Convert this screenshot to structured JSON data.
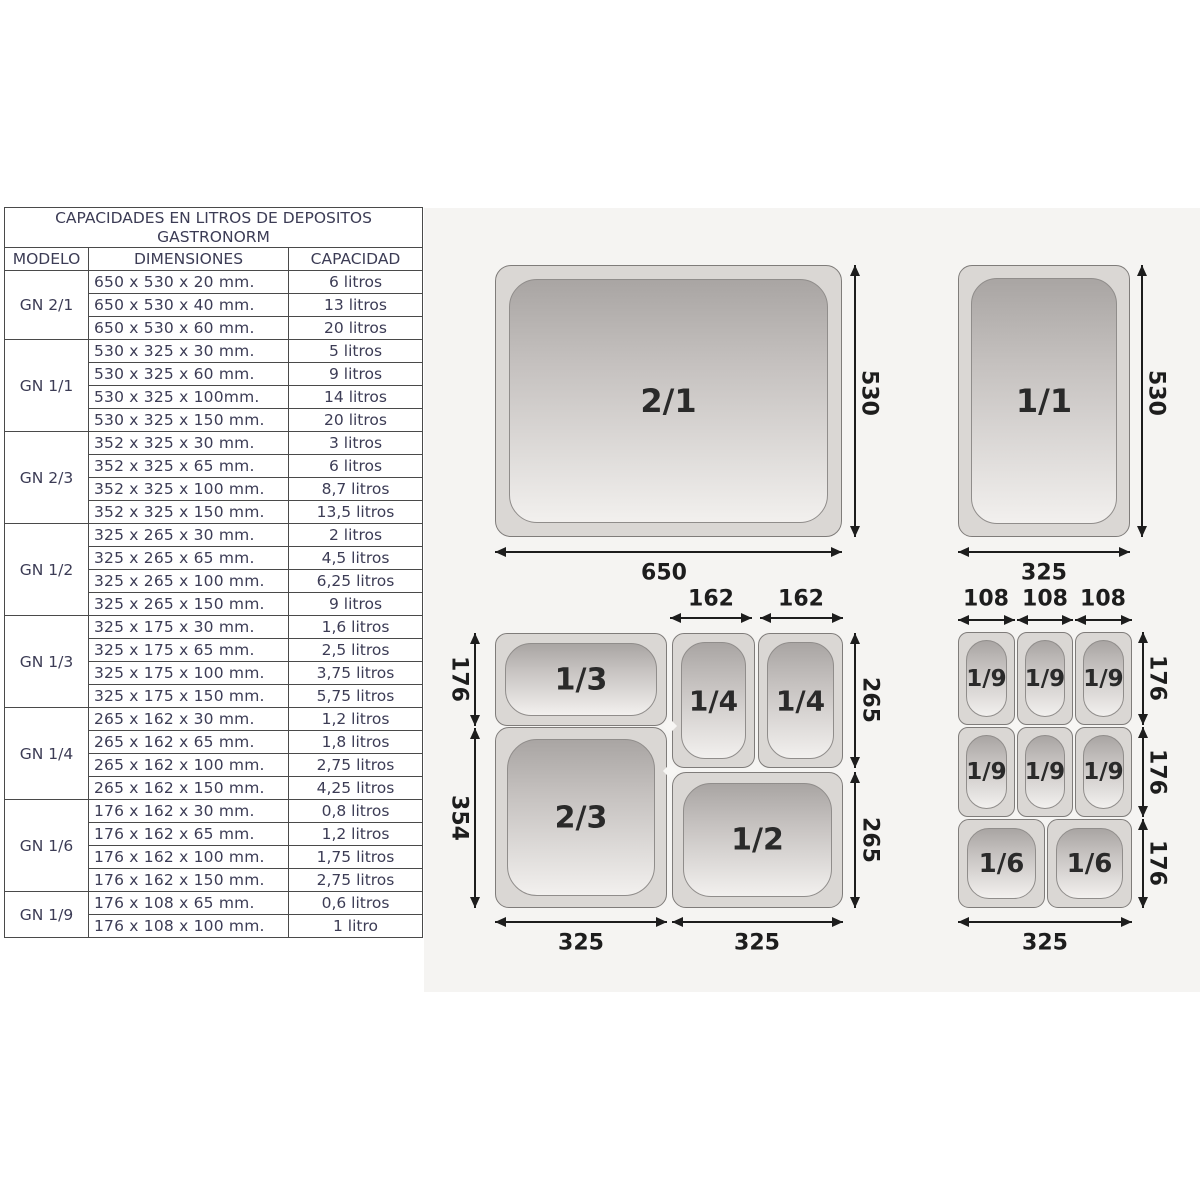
{
  "table": {
    "title_line1": "CAPACIDADES EN LITROS DE DEPOSITOS",
    "title_line2": "GASTRONORM",
    "columns": [
      "MODELO",
      "DIMENSIONES",
      "CAPACIDAD"
    ],
    "groups": [
      {
        "model": "GN 2/1",
        "rows": [
          [
            "650 x 530 x 20 mm.",
            "6 litros"
          ],
          [
            "650 x 530 x 40 mm.",
            "13 litros"
          ],
          [
            "650 x 530 x 60 mm.",
            "20 litros"
          ]
        ]
      },
      {
        "model": "GN 1/1",
        "rows": [
          [
            "530 x 325 x 30 mm.",
            "5 litros"
          ],
          [
            "530 x 325 x 60 mm.",
            "9 litros"
          ],
          [
            "530 x 325 x 100mm.",
            "14 litros"
          ],
          [
            "530 x 325 x 150 mm.",
            "20 litros"
          ]
        ]
      },
      {
        "model": "GN 2/3",
        "rows": [
          [
            "352 x 325 x 30 mm.",
            "3 litros"
          ],
          [
            "352 x 325 x 65 mm.",
            "6 litros"
          ],
          [
            "352 x 325 x 100 mm.",
            "8,7 litros"
          ],
          [
            "352 x 325 x 150 mm.",
            "13,5 litros"
          ]
        ]
      },
      {
        "model": "GN 1/2",
        "rows": [
          [
            "325 x 265 x 30 mm.",
            "2 litros"
          ],
          [
            "325 x 265 x 65 mm.",
            "4,5 litros"
          ],
          [
            "325 x 265 x 100 mm.",
            "6,25 litros"
          ],
          [
            "325 x 265 x 150 mm.",
            "9 litros"
          ]
        ]
      },
      {
        "model": "GN 1/3",
        "rows": [
          [
            "325 x 175 x 30 mm.",
            "1,6 litros"
          ],
          [
            "325 x 175 x 65 mm.",
            "2,5 litros"
          ],
          [
            "325 x 175 x 100 mm.",
            "3,75 litros"
          ],
          [
            "325 x 175 x 150 mm.",
            "5,75 litros"
          ]
        ]
      },
      {
        "model": "GN 1/4",
        "rows": [
          [
            "265 x 162 x 30 mm.",
            "1,2 litros"
          ],
          [
            "265 x 162 x 65 mm.",
            "1,8 litros"
          ],
          [
            "265 x 162 x 100 mm.",
            "2,75 litros"
          ],
          [
            "265 x 162 x 150 mm.",
            "4,25 litros"
          ]
        ]
      },
      {
        "model": "GN 1/6",
        "rows": [
          [
            "176 x 162 x 30 mm.",
            "0,8 litros"
          ],
          [
            "176 x 162 x 65 mm.",
            "1,2 litros"
          ],
          [
            "176 x 162 x 100 mm.",
            "1,75 litros"
          ],
          [
            "176 x 162 x 150 mm.",
            "2,75 litros"
          ]
        ]
      },
      {
        "model": "GN 1/9",
        "rows": [
          [
            "176 x 108 x 65 mm.",
            "0,6 litros"
          ],
          [
            "176 x 108 x 100 mm.",
            "1 litro"
          ]
        ]
      }
    ]
  },
  "diagrams": {
    "gn21": {
      "label": "2/1",
      "width_dim": "650",
      "height_dim": "530"
    },
    "gn11": {
      "label": "1/1",
      "width_dim": "325",
      "height_dim": "530"
    },
    "combo_left": {
      "pan_labels": [
        "1/3",
        "1/4",
        "1/4",
        "2/3",
        "1/2"
      ],
      "top_dims": [
        "162",
        "162"
      ],
      "left_dims": [
        "176",
        "354"
      ],
      "right_dims": [
        "265",
        "265"
      ],
      "bottom_dims": [
        "325",
        "325"
      ]
    },
    "combo_right": {
      "pan_labels": [
        "1/9",
        "1/9",
        "1/9",
        "1/9",
        "1/9",
        "1/9",
        "1/6",
        "1/6"
      ],
      "top_dims": [
        "108",
        "108",
        "108"
      ],
      "right_dims": [
        "176",
        "176",
        "176"
      ],
      "bottom_dims": [
        "325"
      ]
    }
  },
  "colors": {
    "diagram_background": "#f5f4f2",
    "pan_rim": "#dad7d4",
    "pan_well_top": "#a9a5a3",
    "pan_well_bottom": "#f2f0ee",
    "table_text": "#3c3c55",
    "dimension_ink": "#1d1d1d"
  }
}
